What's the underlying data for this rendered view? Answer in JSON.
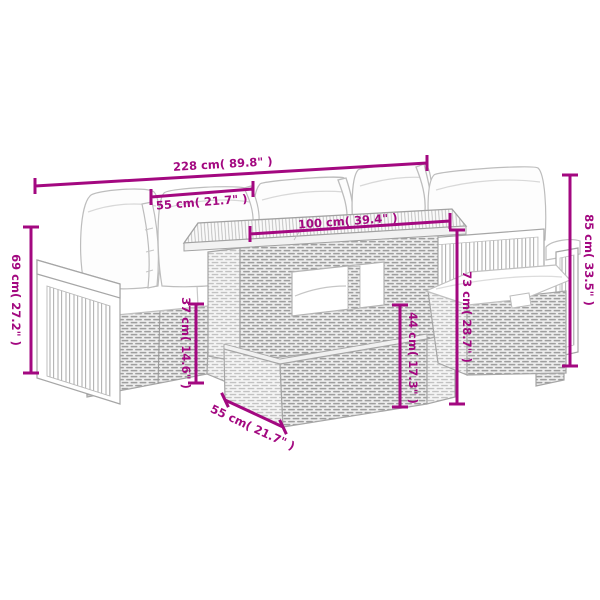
{
  "diagram": {
    "accent_color": "#A30880",
    "line_art_color": "#A6A6A6",
    "background_color": "#FFFFFF",
    "subject_parts": [
      "left-modular-sofa-with-cushions",
      "rear-chairs-with-pillows",
      "rattan-table-with-wood-slat-top",
      "ottoman-with-cushion"
    ]
  },
  "dims": {
    "total_width": "228 cm( 89.8\" )",
    "module_width": "55 cm( 21.7\" )",
    "tabletop_length": "100 cm( 39.4\" )",
    "overall_height": "85 cm( 33.5\" )",
    "table_height": "73 cm( 28.7\" )",
    "armrest_height": "69 cm( 27.2\" )",
    "seat_height": "37 cm( 14.6\" )",
    "table_base_height": "44 cm( 17.3\" )",
    "depth": "55 cm( 21.7\" )"
  }
}
